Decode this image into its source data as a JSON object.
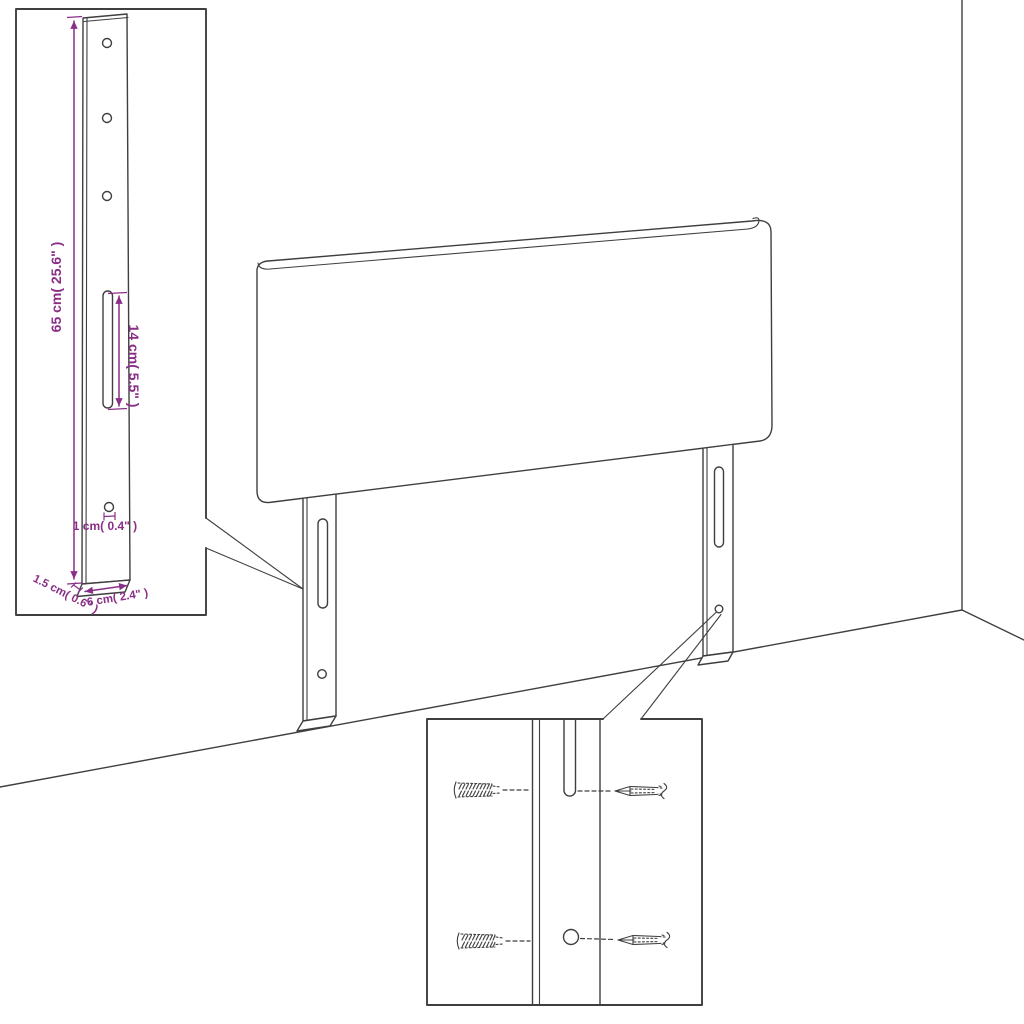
{
  "diagram": {
    "type": "product-dimension-diagram",
    "subject": "upholstered headboard with two slotted mounting legs, wall-mounting detail views",
    "dimensions": {
      "leg_height": "65 cm( 25.6\" )",
      "slot_length": "14 cm( 5.5\" )",
      "hole_size": "1 cm( 0.4\" )",
      "side_thickness": "1.5 cm( 0.6\" )",
      "leg_width": "6 cm( 2.4\" )"
    }
  },
  "colors": {
    "line": "#3f3f3f",
    "accent": "#8a2f88",
    "bg": "#ffffff"
  }
}
